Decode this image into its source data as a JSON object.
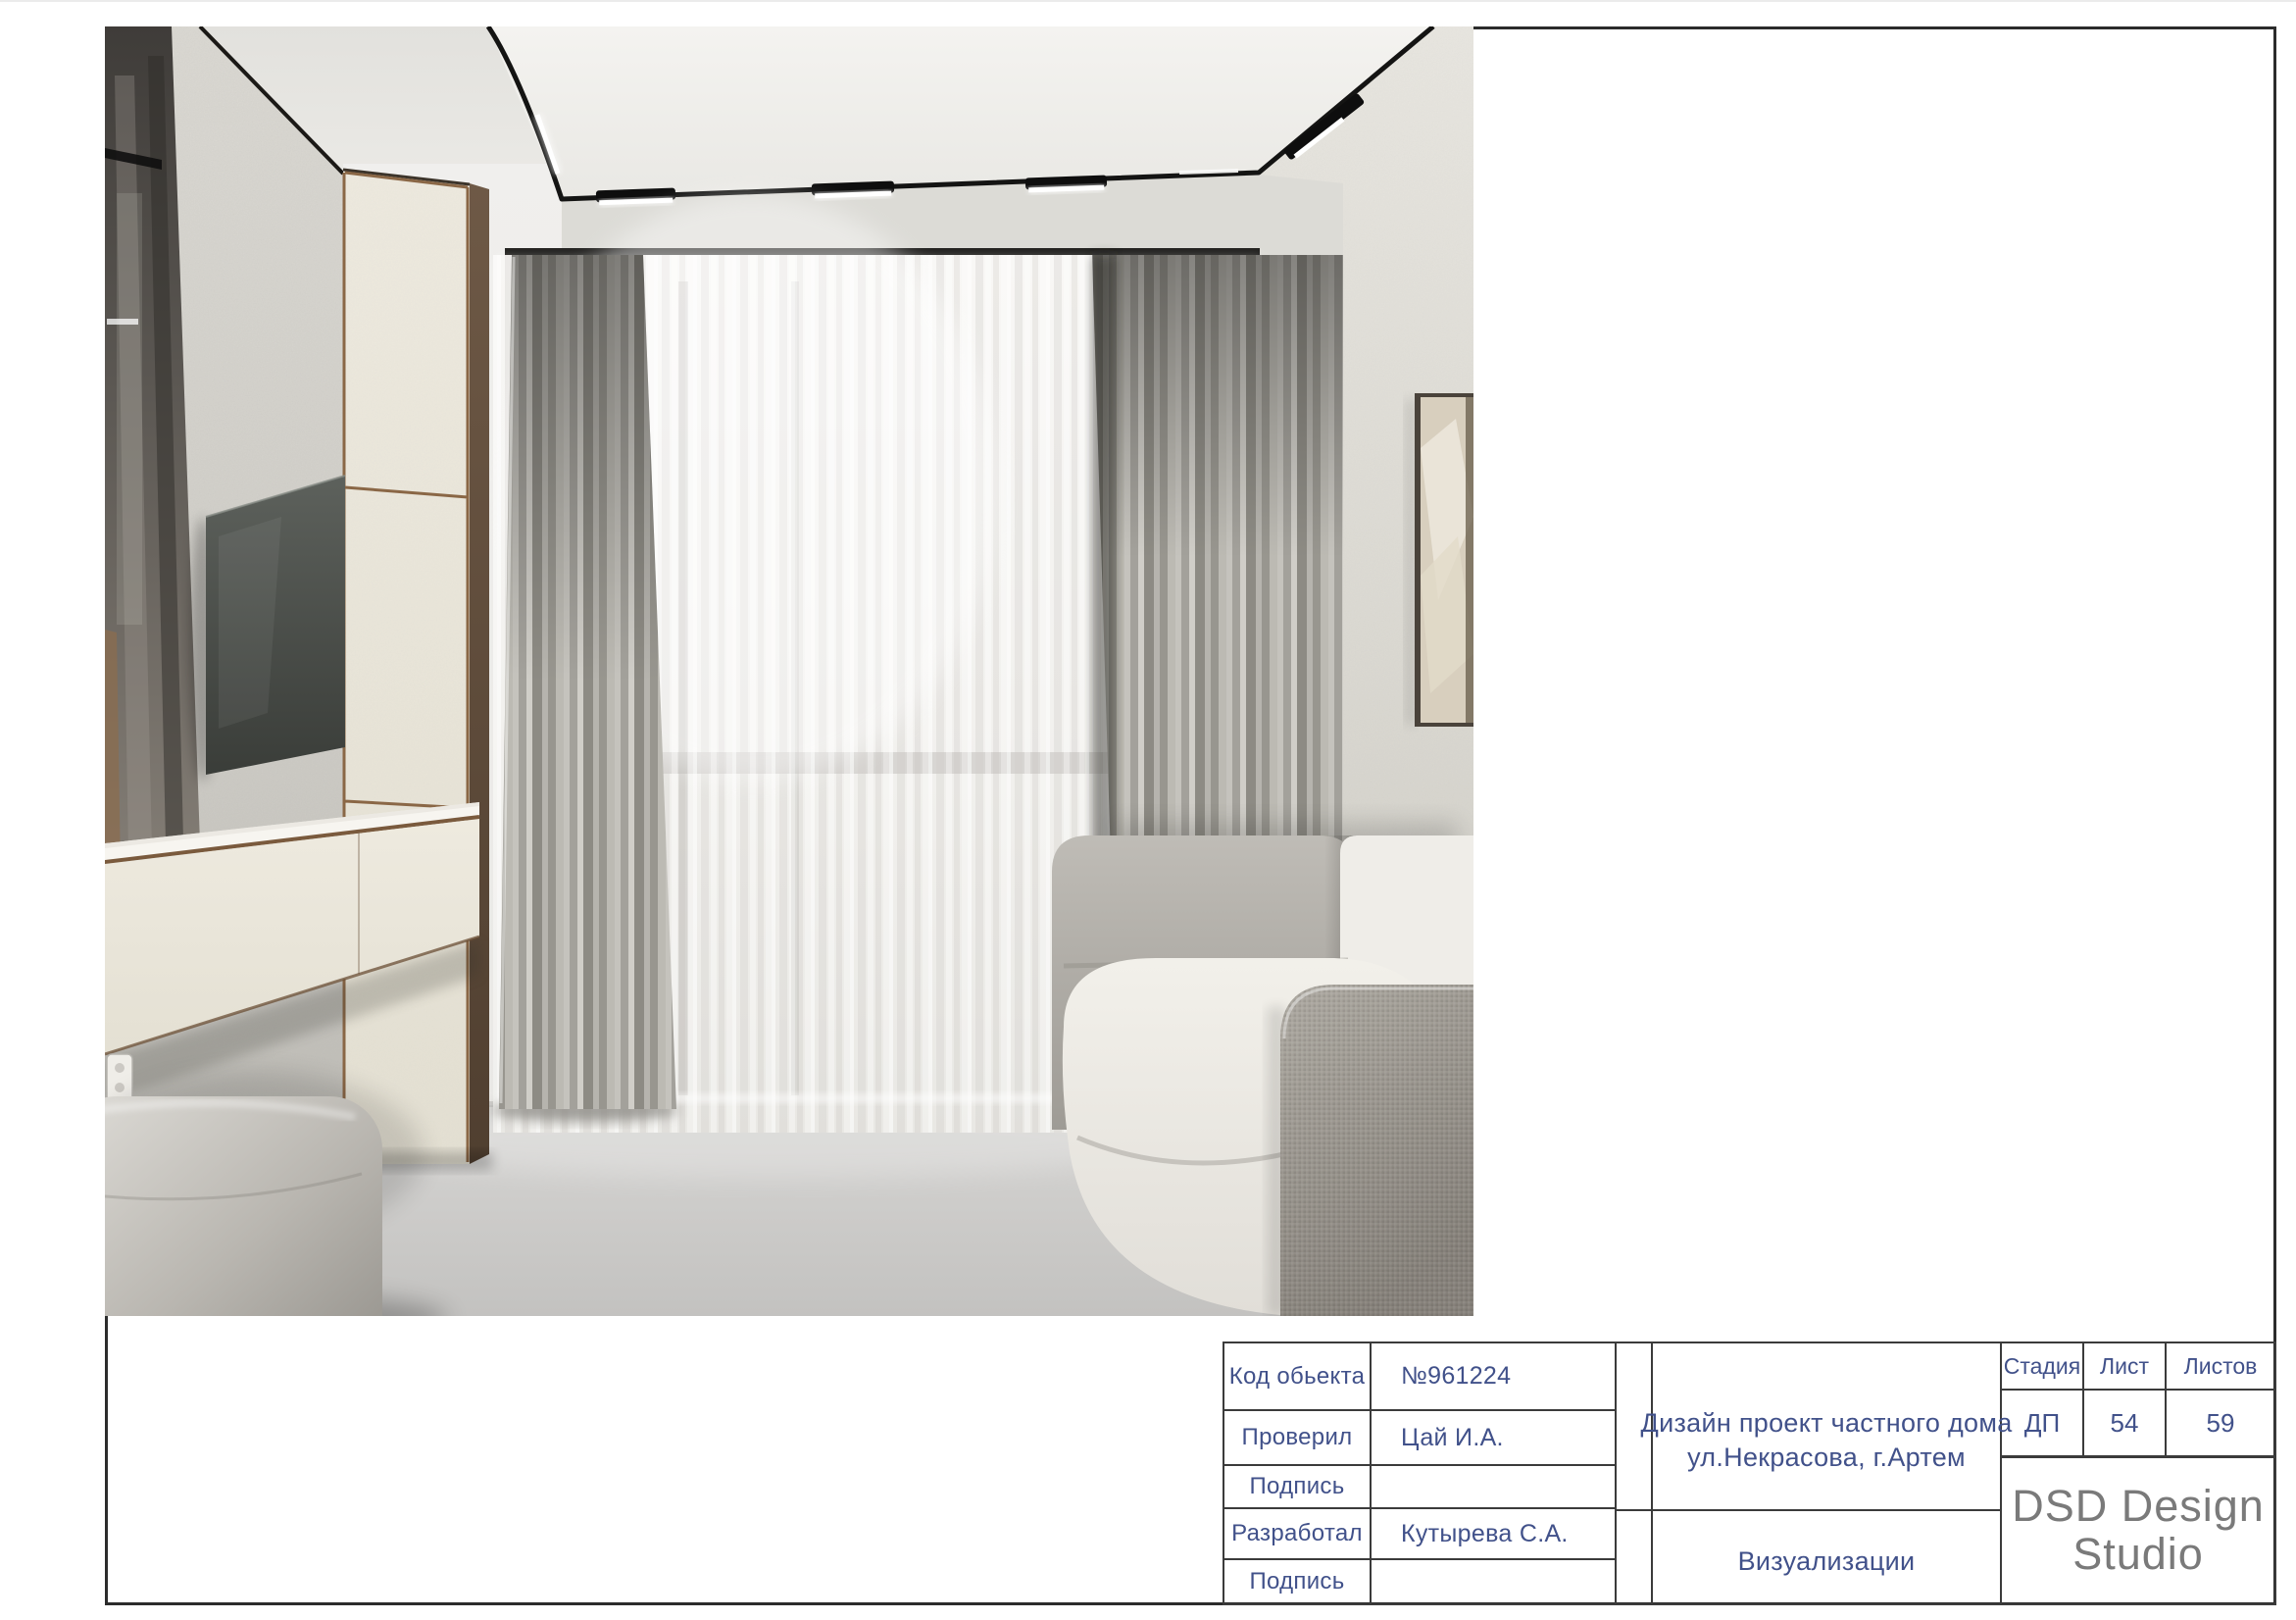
{
  "title_block": {
    "rows": [
      {
        "label": "Код обьекта",
        "value": "№961224"
      },
      {
        "label": "Проверил",
        "value": "Цай И.А."
      },
      {
        "label": "Подпись",
        "value": ""
      },
      {
        "label": "Разработал",
        "value": "Кутырева С.А."
      },
      {
        "label": "Подпись",
        "value": ""
      }
    ],
    "project_line1": "Дизайн проект частного дома",
    "project_line2": "ул.Некрасова, г.Артем",
    "section_title": "Визуализации",
    "stage_header": "Стадия",
    "sheet_header": "Лист",
    "sheets_header": "Листов",
    "stage_value": "ДП",
    "sheet_value": "54",
    "sheets_value": "59",
    "studio_line1": "DSD Design",
    "studio_line2": "Studio"
  },
  "colors": {
    "ink": "#41518a",
    "studio_gray": "#7a7a7a",
    "table_line": "#3b3b3b",
    "frame": "#2c2c2c",
    "render_wall": "#d8d6d0",
    "render_ceiling": "#f2f1ee",
    "render_drape": "#a3a19a",
    "render_floor": "#cfcecc",
    "render_wood_trim": "#8a6746"
  }
}
